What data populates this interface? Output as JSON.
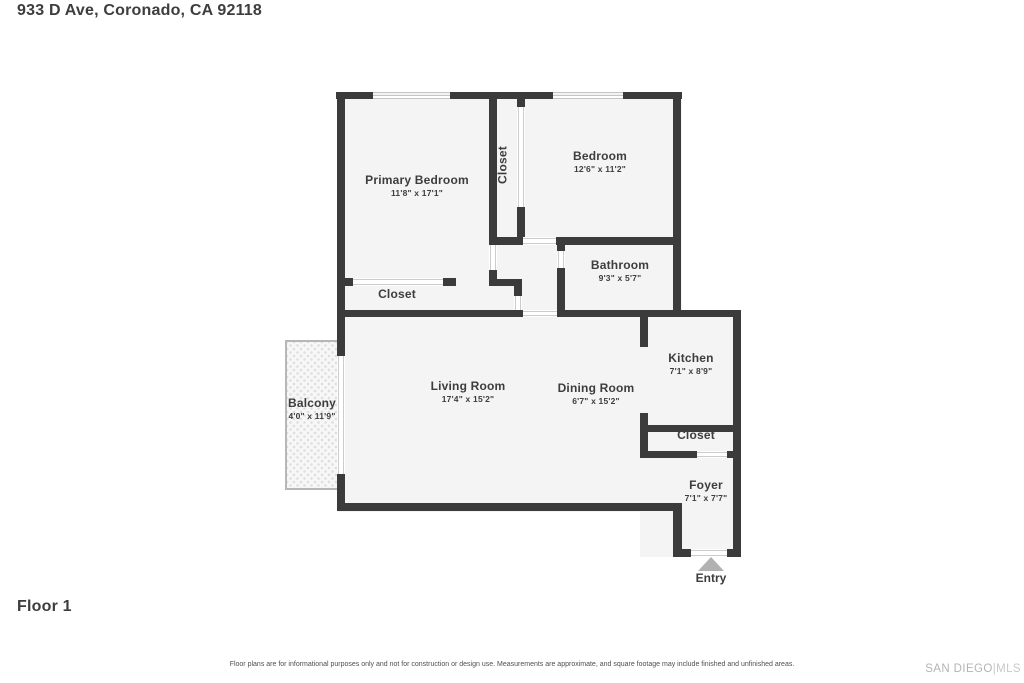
{
  "header": {
    "title": "933 D Ave, Coronado, CA 92118"
  },
  "floor_plan": {
    "rooms": [
      {
        "id": "primary-bedroom",
        "name": "Primary Bedroom",
        "dims": "11'8\" x 17'1\""
      },
      {
        "id": "bedroom",
        "name": "Bedroom",
        "dims": "12'6\" x 11'2\""
      },
      {
        "id": "hall-closet",
        "name": "Closet",
        "dims": ""
      },
      {
        "id": "bathroom",
        "name": "Bathroom",
        "dims": "9'3\" x 5'7\""
      },
      {
        "id": "primary-closet",
        "name": "Closet",
        "dims": ""
      },
      {
        "id": "living-room",
        "name": "Living Room",
        "dims": "17'4\" x 15'2\""
      },
      {
        "id": "dining-room",
        "name": "Dining Room",
        "dims": "6'7\" x 15'2\""
      },
      {
        "id": "kitchen",
        "name": "Kitchen",
        "dims": "7'1\" x 8'9\""
      },
      {
        "id": "entry-closet",
        "name": "Closet",
        "dims": ""
      },
      {
        "id": "foyer",
        "name": "Foyer",
        "dims": "7'1\" x 7'7\""
      },
      {
        "id": "balcony",
        "name": "Balcony",
        "dims": "4'0\" x 11'9\""
      }
    ],
    "entry_label": "Entry"
  },
  "footer": {
    "floor_label": "Floor 1",
    "disclaimer": "Floor plans are for informational purposes only and not for construction or design use. Measurements are approximate, and square footage may include finished and unfinished areas.",
    "brand": {
      "primary": "SAN DIEGO",
      "separator": "|",
      "secondary": "MLS"
    }
  },
  "colors": {
    "wall": "#3b3b3b",
    "floor_fill": "#f4f4f4",
    "text": "#3d3d3d",
    "opening_line": "#c6c6c6",
    "entry_arrow": "#b1b1b1",
    "brand_gray": "#b4b4b4"
  }
}
